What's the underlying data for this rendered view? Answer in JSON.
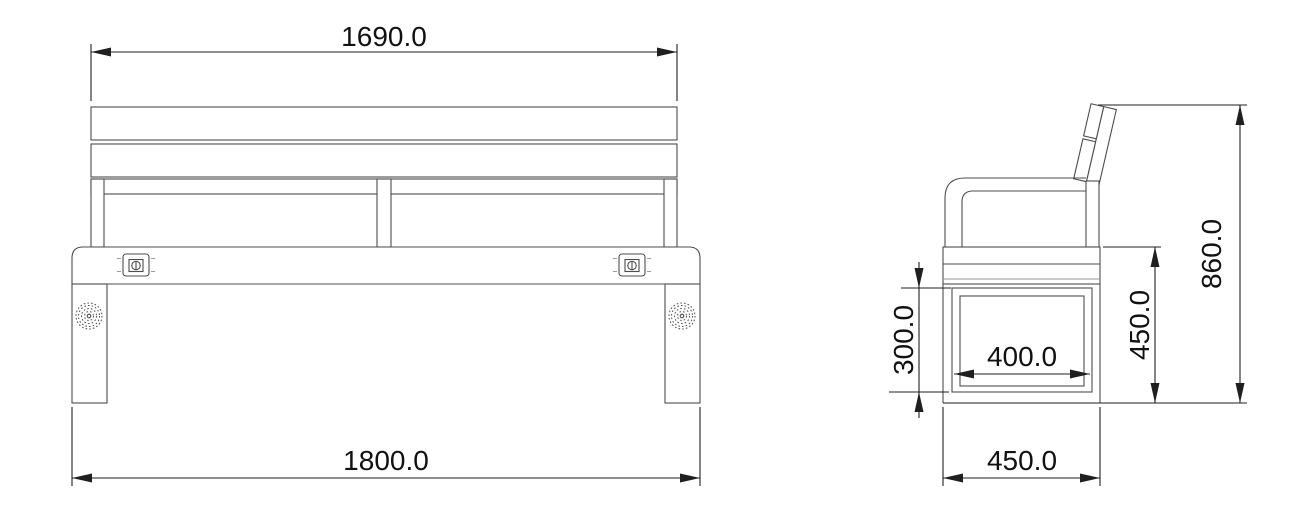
{
  "drawing": {
    "title": "park bench technical drawing",
    "front_view": {
      "dim_top": "1690.0",
      "dim_bottom": "1800.0"
    },
    "side_view": {
      "dim_overall_height": "860.0",
      "dim_seat_height": "450.0",
      "dim_panel_height": "300.0",
      "dim_panel_width": "400.0",
      "dim_base_depth": "450.0"
    },
    "icons": {
      "charging_port": "charging-port-icon",
      "speaker": "speaker-grille-icon"
    },
    "colors": {
      "background": "#ffffff",
      "outline": "#4d4d4d",
      "dimension": "#1f1f1f",
      "text": "#111111"
    }
  }
}
